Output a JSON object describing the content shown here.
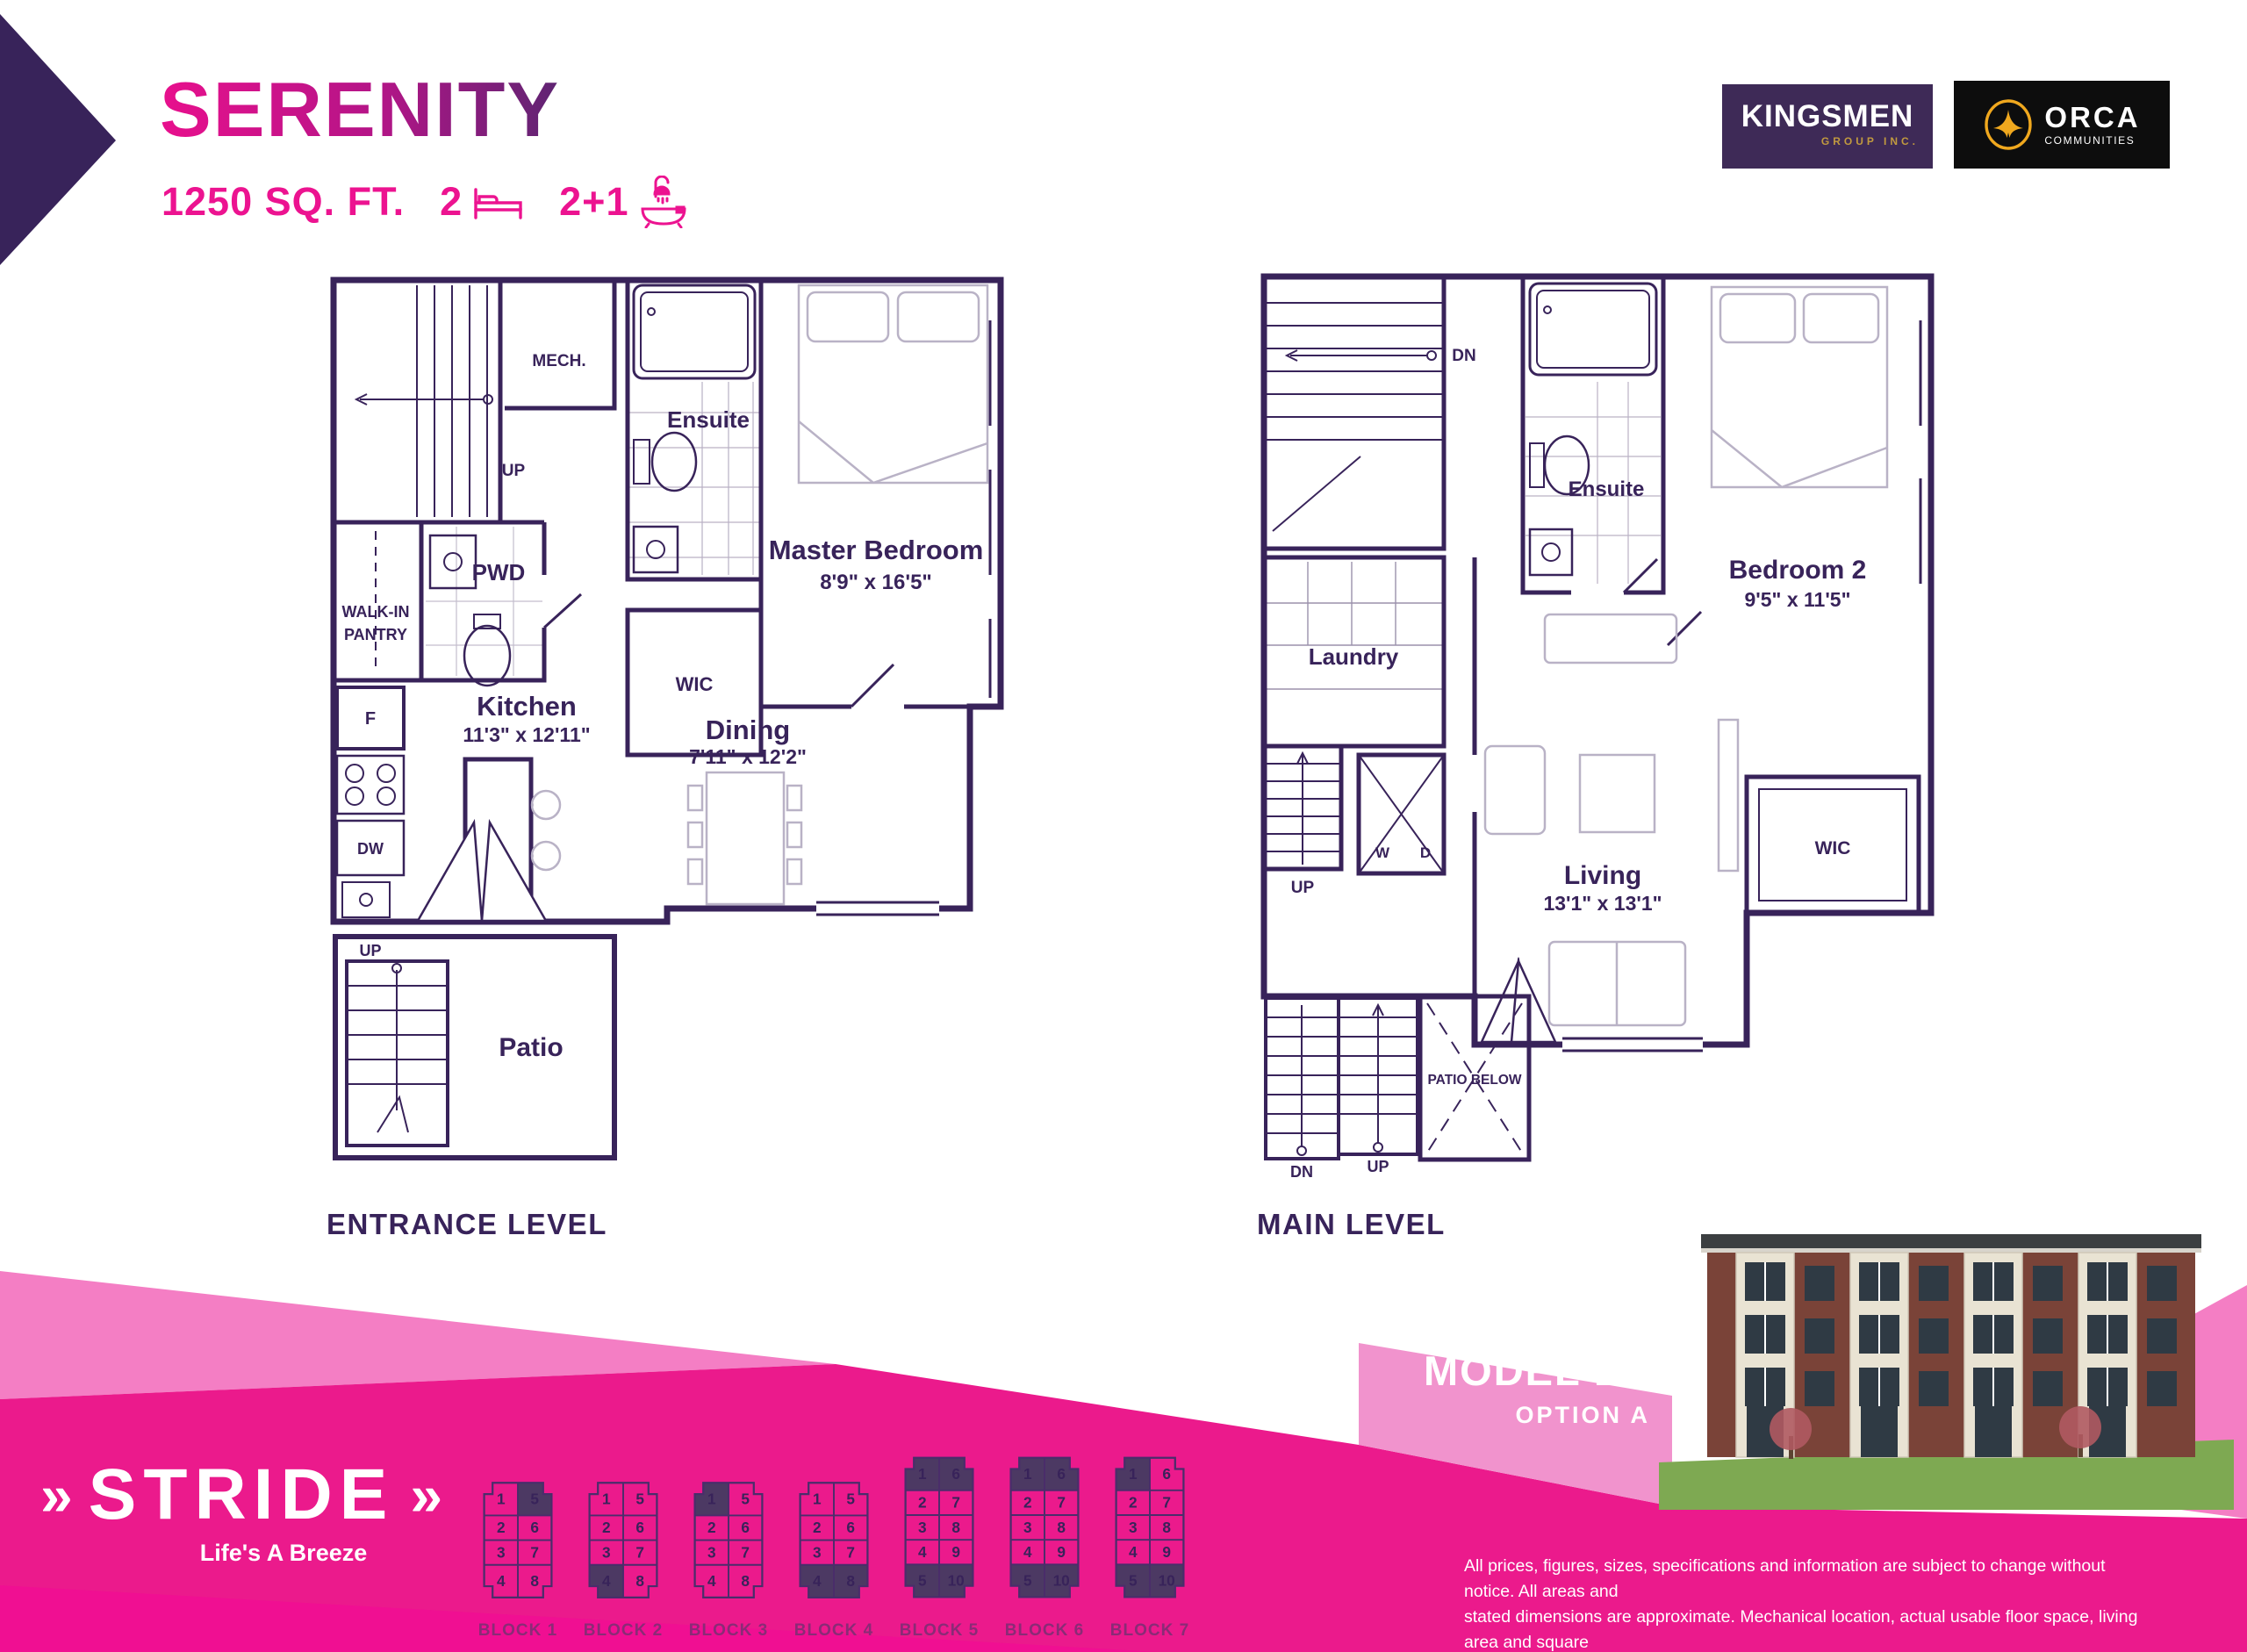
{
  "header": {
    "plan_name": "SERENITY",
    "area": "1250 SQ. FT.",
    "beds": "2",
    "baths": "2+1"
  },
  "logos": {
    "kingsmen": {
      "name": "KINGSMEN",
      "sub": "GROUP INC."
    },
    "orca": {
      "name": "ORCA",
      "sub": "COMMUNITIES"
    }
  },
  "plans": {
    "entrance": {
      "title": "ENTRANCE LEVEL",
      "labels": {
        "mech": "MECH.",
        "up_stairs": "UP",
        "ensuite": "Ensuite",
        "pantry_line1": "WALK-IN",
        "pantry_line2": "PANTRY",
        "pwd": "PWD",
        "wic": "WIC",
        "master_name": "Master Bedroom",
        "master_dims": "8'9\" x 16'5\"",
        "kitchen_name": "Kitchen",
        "kitchen_dims": "11'3\" x 12'11\"",
        "dining_name": "Dining",
        "dining_dims": "7'11\" x 12'2\"",
        "fridge": "F",
        "dishwasher": "DW",
        "patio_up": "UP",
        "patio": "Patio"
      }
    },
    "main": {
      "title": "MAIN LEVEL",
      "labels": {
        "dn": "DN",
        "laundry": "Laundry",
        "washer": "W",
        "dryer": "D",
        "ensuite": "Ensuite",
        "bedroom2_name": "Bedroom 2",
        "bedroom2_dims": "9'5\" x 11'5\"",
        "wic": "WIC",
        "up_stairs": "UP",
        "living_name": "Living",
        "living_dims": "13'1\" x 13'1\"",
        "patio_below": "PATIO BELOW",
        "dn_exterior": "DN",
        "up_exterior": "UP"
      }
    }
  },
  "footer": {
    "brand": "STRIDE",
    "tagline": "Life's A Breeze",
    "model": "MODEL B1",
    "option": "OPTION A",
    "disclaimer_lines": [
      "All prices, figures, sizes, specifications and information are subject to change without notice. All areas and",
      "stated dimensions are approximate. Mechanical location, actual usable floor space, living area and square",
      "footage may vary from stated floor area. Illustrations are artist's concept. E. & O. E."
    ]
  },
  "colors": {
    "purple": "#38235A",
    "pink": "#EC1390",
    "magenta": "#EB1A8C",
    "light_pink": "#F47EC4",
    "band_pink": "#F193CD",
    "block_highlight": "#4C3963"
  },
  "blocks": [
    {
      "label": "BLOCK 1",
      "rows": 4,
      "left": [
        1,
        2,
        3,
        4
      ],
      "right": [
        5,
        6,
        7,
        8
      ],
      "highlighted": [
        5
      ]
    },
    {
      "label": "BLOCK 2",
      "rows": 4,
      "left": [
        1,
        2,
        3,
        4
      ],
      "right": [
        5,
        6,
        7,
        8
      ],
      "highlighted": [
        4
      ]
    },
    {
      "label": "BLOCK 3",
      "rows": 4,
      "left": [
        1,
        2,
        3,
        4
      ],
      "right": [
        5,
        6,
        7,
        8
      ],
      "highlighted": [
        1
      ]
    },
    {
      "label": "BLOCK 4",
      "rows": 4,
      "left": [
        1,
        2,
        3,
        4
      ],
      "right": [
        5,
        6,
        7,
        8
      ],
      "highlighted": [
        4,
        8
      ]
    },
    {
      "label": "BLOCK 5",
      "rows": 5,
      "left": [
        1,
        2,
        3,
        4,
        5
      ],
      "right": [
        6,
        7,
        8,
        9,
        10
      ],
      "highlighted": [
        1,
        6,
        5,
        10
      ]
    },
    {
      "label": "BLOCK 6",
      "rows": 5,
      "left": [
        1,
        2,
        3,
        4,
        5
      ],
      "right": [
        6,
        7,
        8,
        9,
        10
      ],
      "highlighted": [
        1,
        6,
        5,
        10
      ]
    },
    {
      "label": "BLOCK 7",
      "rows": 5,
      "left": [
        1,
        2,
        3,
        4,
        5
      ],
      "right": [
        6,
        7,
        8,
        9,
        10
      ],
      "highlighted": [
        1,
        5,
        10
      ]
    }
  ]
}
